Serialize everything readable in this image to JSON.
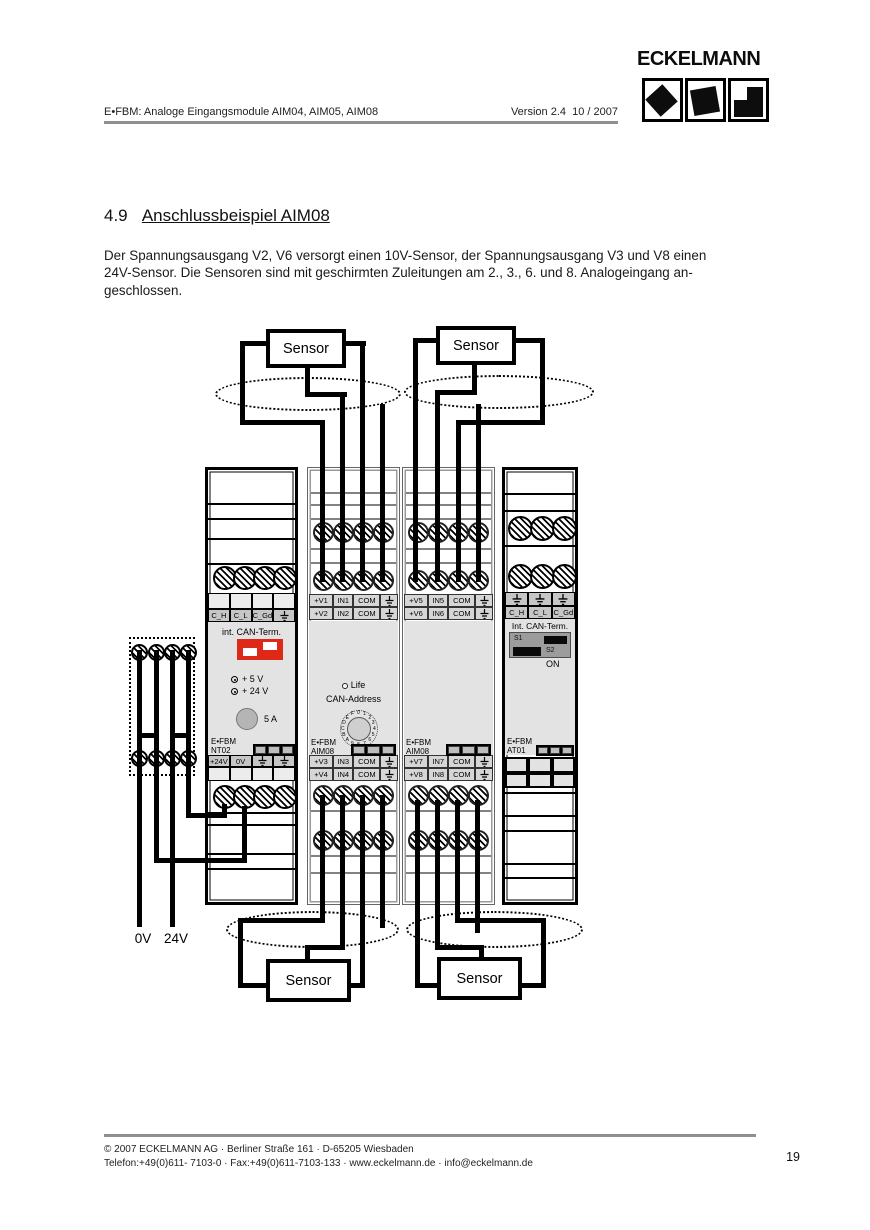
{
  "header": {
    "doc_title": "E•FBM: Analoge Eingangsmodule AIM04, AIM05, AIM08",
    "version": "Version 2.4",
    "date": "10 / 2007",
    "logo_text": "ECKELMANN"
  },
  "section": {
    "number": "4.9",
    "title": "Anschlussbeispiel AIM08"
  },
  "body": {
    "lines": [
      "Der Spannungsausgang V2, V6 versorgt einen 10V-Sensor, der Spannungsausgang V3 und V8 einen",
      "24V-Sensor. Die Sensoren sind mit geschirmten Zuleitungen am 2., 3., 6. und 8. Analogeingang an-",
      "geschlossen."
    ]
  },
  "diagram": {
    "sensor_label": "Sensor",
    "supply": {
      "zero": "0V",
      "twentyfour": "24V"
    },
    "nt02": {
      "can_labels": [
        "C_H",
        "C_L",
        "C_Gd"
      ],
      "can_term_label": "int. CAN-Term.",
      "led_5v": "+ 5 V",
      "led_24v": "+ 24 V",
      "fuse_label": "5 A",
      "brand": "E•FBM",
      "model": "NT02",
      "power_labels": [
        "+24V",
        "0V"
      ]
    },
    "aim08_1": {
      "brand": "E•FBM",
      "model": "AIM08",
      "life_label": "Life",
      "can_address_label": "CAN-Address",
      "dial_digits": "0123456789ABCDEF",
      "top_rows": [
        [
          "+V1",
          "IN1",
          "COM"
        ],
        [
          "+V2",
          "IN2",
          "COM"
        ]
      ],
      "bottom_rows": [
        [
          "+V3",
          "IN3",
          "COM"
        ],
        [
          "+V4",
          "IN4",
          "COM"
        ]
      ]
    },
    "aim08_2": {
      "brand": "E•FBM",
      "model": "AIM08",
      "top_rows": [
        [
          "+V5",
          "IN5",
          "COM"
        ],
        [
          "+V6",
          "IN6",
          "COM"
        ]
      ],
      "bottom_rows": [
        [
          "+V7",
          "IN7",
          "COM"
        ],
        [
          "+V8",
          "IN8",
          "COM"
        ]
      ]
    },
    "at01": {
      "brand": "E•FBM",
      "model": "AT01",
      "can_labels": [
        "C_H",
        "C_L",
        "C_Gd"
      ],
      "can_term_label": "Int. CAN-Term.",
      "s1": "S1",
      "s2": "S2",
      "on_label": "ON"
    }
  },
  "footer": {
    "line1": "©  2007 ECKELMANN AG · Berliner Straße 161 · D-65205 Wiesbaden",
    "line2": "Telefon:+49(0)611- 7103-0 · Fax:+49(0)611-7103-133 · www.eckelmann.de · info@eckelmann.de",
    "page_number": "19"
  }
}
